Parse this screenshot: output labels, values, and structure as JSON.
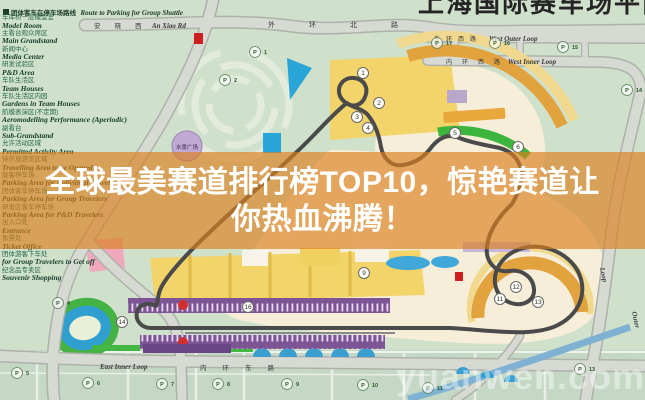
{
  "overlay": {
    "line1": "全球最美赛道排行榜TOP10，惊艳赛道让",
    "line2": "你热血沸腾！"
  },
  "watermark": "yuanwen.com",
  "top_partial_title": "上海国际赛车场平面图",
  "legend": {
    "header_zh": "团体客车在停车场路线",
    "header_en": "Route to Parking for Group Shuttle",
    "items": [
      {
        "zh": "车库桥一层模型室",
        "en": "Model Room"
      },
      {
        "zh": "主看台观众席区",
        "en": "Main Grandstand"
      },
      {
        "zh": "新闻中心",
        "en": "Media Center"
      },
      {
        "zh": "研发试验区",
        "en": "P&D Area"
      },
      {
        "zh": "车队生活区",
        "en": "Team Houses"
      },
      {
        "zh": "车队生活区内园",
        "en": "Gardens in Team Houses"
      },
      {
        "zh": "航模表演区(不定期)",
        "en": "Aeromodelling Performance (Aperiodic)"
      },
      {
        "zh": "副看台",
        "en": "Sub-Grandstand"
      },
      {
        "zh": "允许活动区域",
        "en": "Permitted Activity Area"
      },
      {
        "zh": "待开放游览区域",
        "en": "Travelling Area to be Opened"
      },
      {
        "zh": "散客停车场",
        "en": "Parking Area for Individual Travelers"
      },
      {
        "zh": "团体客车停车场",
        "en": "Parking Area for Group Travelers"
      },
      {
        "zh": "研发区客车停车场",
        "en": "Parking Area for P&D Travelers"
      },
      {
        "zh": "出入口处",
        "en": "Entrance"
      },
      {
        "zh": "售票处",
        "en": "Ticket Office"
      },
      {
        "zh": "团体游客下车处",
        "en": "for Group Travelers to Get off"
      },
      {
        "zh": "纪念品专卖区",
        "en": "Souvenir Shopping"
      }
    ]
  },
  "map": {
    "plaza_label": "水景广场",
    "roads": {
      "an_xiao_zh": "安晓西",
      "an_xiao_en": "An Xiao Rd",
      "north_zh": "外环北路",
      "west_outer_zh": "外环西路",
      "west_outer_en": "West Outer Loop",
      "west_inner_zh": "内环西路",
      "west_inner_en": "West Inner Loop",
      "east_inner_en": "East Inner Loop",
      "east_inner_zh": "内环东路",
      "outer_right_word1": "Outer",
      "outer_right_word2": "Loop"
    },
    "parking_markers": [
      {
        "n": "1",
        "x": 255,
        "y": 52
      },
      {
        "n": "2",
        "x": 225,
        "y": 80
      },
      {
        "n": "4",
        "x": 58,
        "y": 303
      },
      {
        "n": "5",
        "x": 17,
        "y": 373
      },
      {
        "n": "6",
        "x": 88,
        "y": 383
      },
      {
        "n": "7",
        "x": 162,
        "y": 384
      },
      {
        "n": "8",
        "x": 218,
        "y": 384
      },
      {
        "n": "9",
        "x": 287,
        "y": 384
      },
      {
        "n": "10",
        "x": 363,
        "y": 385
      },
      {
        "n": "11",
        "x": 428,
        "y": 388
      },
      {
        "n": "13",
        "x": 580,
        "y": 369
      },
      {
        "n": "14",
        "x": 627,
        "y": 90
      },
      {
        "n": "15",
        "x": 563,
        "y": 47
      },
      {
        "n": "16",
        "x": 495,
        "y": 43
      },
      {
        "n": "17",
        "x": 437,
        "y": 43
      }
    ],
    "turn_markers": [
      {
        "n": "1",
        "x": 363,
        "y": 73
      },
      {
        "n": "2",
        "x": 379,
        "y": 103
      },
      {
        "n": "3",
        "x": 357,
        "y": 117
      },
      {
        "n": "4",
        "x": 368,
        "y": 128
      },
      {
        "n": "5",
        "x": 455,
        "y": 133
      },
      {
        "n": "6",
        "x": 518,
        "y": 147
      },
      {
        "n": "9",
        "x": 364,
        "y": 273
      },
      {
        "n": "11",
        "x": 500,
        "y": 299
      },
      {
        "n": "12",
        "x": 516,
        "y": 287
      },
      {
        "n": "13",
        "x": 538,
        "y": 302
      },
      {
        "n": "14",
        "x": 122,
        "y": 322
      },
      {
        "n": "16",
        "x": 248,
        "y": 307
      }
    ],
    "colors": {
      "background_green": "#cfe0cb",
      "overlay_orange": "#db821e",
      "track_gray": "#4a4a4a",
      "grandstand_purple": "#7d5494",
      "grandstand_arc_orange": "#e2a23e",
      "paddock_yellow": "#f2d469",
      "water_blue": "#2aa5d8",
      "legend_text_green": "#17402c"
    }
  }
}
